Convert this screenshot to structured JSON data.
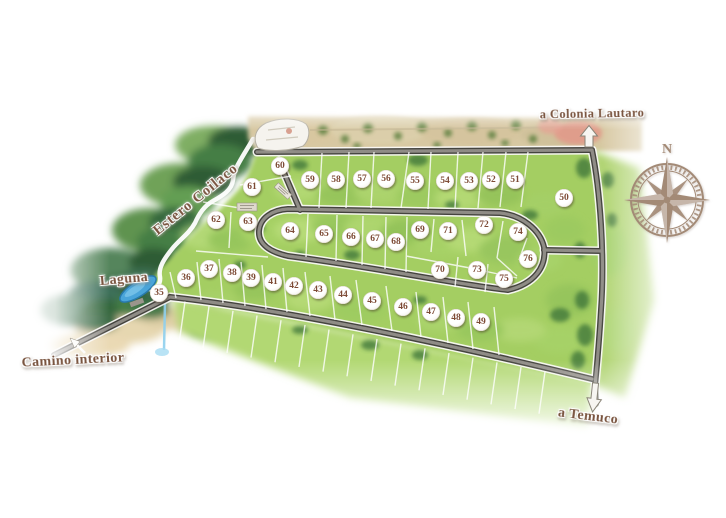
{
  "labels": {
    "estero": "Estero Coilaco",
    "laguna": "Laguna",
    "camino_interior": "Camino interior",
    "a_colonia_lautaro": "a Colonia Lautaro",
    "a_temuco": "a Temuco",
    "compass_n": "N"
  },
  "lots": [
    {
      "n": "35",
      "x": 159,
      "y": 293
    },
    {
      "n": "36",
      "x": 186,
      "y": 278
    },
    {
      "n": "37",
      "x": 209,
      "y": 269
    },
    {
      "n": "38",
      "x": 232,
      "y": 273
    },
    {
      "n": "39",
      "x": 251,
      "y": 278
    },
    {
      "n": "41",
      "x": 273,
      "y": 282
    },
    {
      "n": "42",
      "x": 294,
      "y": 286
    },
    {
      "n": "43",
      "x": 318,
      "y": 290
    },
    {
      "n": "44",
      "x": 343,
      "y": 295
    },
    {
      "n": "45",
      "x": 372,
      "y": 301
    },
    {
      "n": "46",
      "x": 403,
      "y": 307
    },
    {
      "n": "47",
      "x": 431,
      "y": 312
    },
    {
      "n": "48",
      "x": 456,
      "y": 318
    },
    {
      "n": "49",
      "x": 481,
      "y": 322
    },
    {
      "n": "50",
      "x": 564,
      "y": 198
    },
    {
      "n": "51",
      "x": 515,
      "y": 180
    },
    {
      "n": "52",
      "x": 491,
      "y": 180
    },
    {
      "n": "53",
      "x": 469,
      "y": 181
    },
    {
      "n": "54",
      "x": 445,
      "y": 181
    },
    {
      "n": "55",
      "x": 415,
      "y": 181
    },
    {
      "n": "56",
      "x": 386,
      "y": 179
    },
    {
      "n": "57",
      "x": 362,
      "y": 179
    },
    {
      "n": "58",
      "x": 336,
      "y": 180
    },
    {
      "n": "59",
      "x": 310,
      "y": 180
    },
    {
      "n": "60",
      "x": 280,
      "y": 166
    },
    {
      "n": "61",
      "x": 252,
      "y": 187
    },
    {
      "n": "62",
      "x": 216,
      "y": 220
    },
    {
      "n": "63",
      "x": 248,
      "y": 222
    },
    {
      "n": "64",
      "x": 290,
      "y": 231
    },
    {
      "n": "65",
      "x": 324,
      "y": 234
    },
    {
      "n": "66",
      "x": 351,
      "y": 237
    },
    {
      "n": "67",
      "x": 375,
      "y": 239
    },
    {
      "n": "68",
      "x": 396,
      "y": 242
    },
    {
      "n": "69",
      "x": 420,
      "y": 230
    },
    {
      "n": "70",
      "x": 440,
      "y": 270
    },
    {
      "n": "71",
      "x": 448,
      "y": 231
    },
    {
      "n": "72",
      "x": 484,
      "y": 225
    },
    {
      "n": "73",
      "x": 477,
      "y": 270
    },
    {
      "n": "74",
      "x": 518,
      "y": 232
    },
    {
      "n": "75",
      "x": 504,
      "y": 279
    },
    {
      "n": "76",
      "x": 528,
      "y": 259
    }
  ],
  "colors": {
    "label_text": "#7a5540",
    "lot_number": "#7d4a35",
    "compass": "#a38a76",
    "road_dark": "#45443f",
    "road_light": "#8f8c86",
    "road_casing": "#fbfaf7",
    "green_base": "#a4ce62",
    "forest_dark": "#2e5c35",
    "laguna_blue": "#4aa5da",
    "top_field_tan": "#d7c8a2"
  }
}
